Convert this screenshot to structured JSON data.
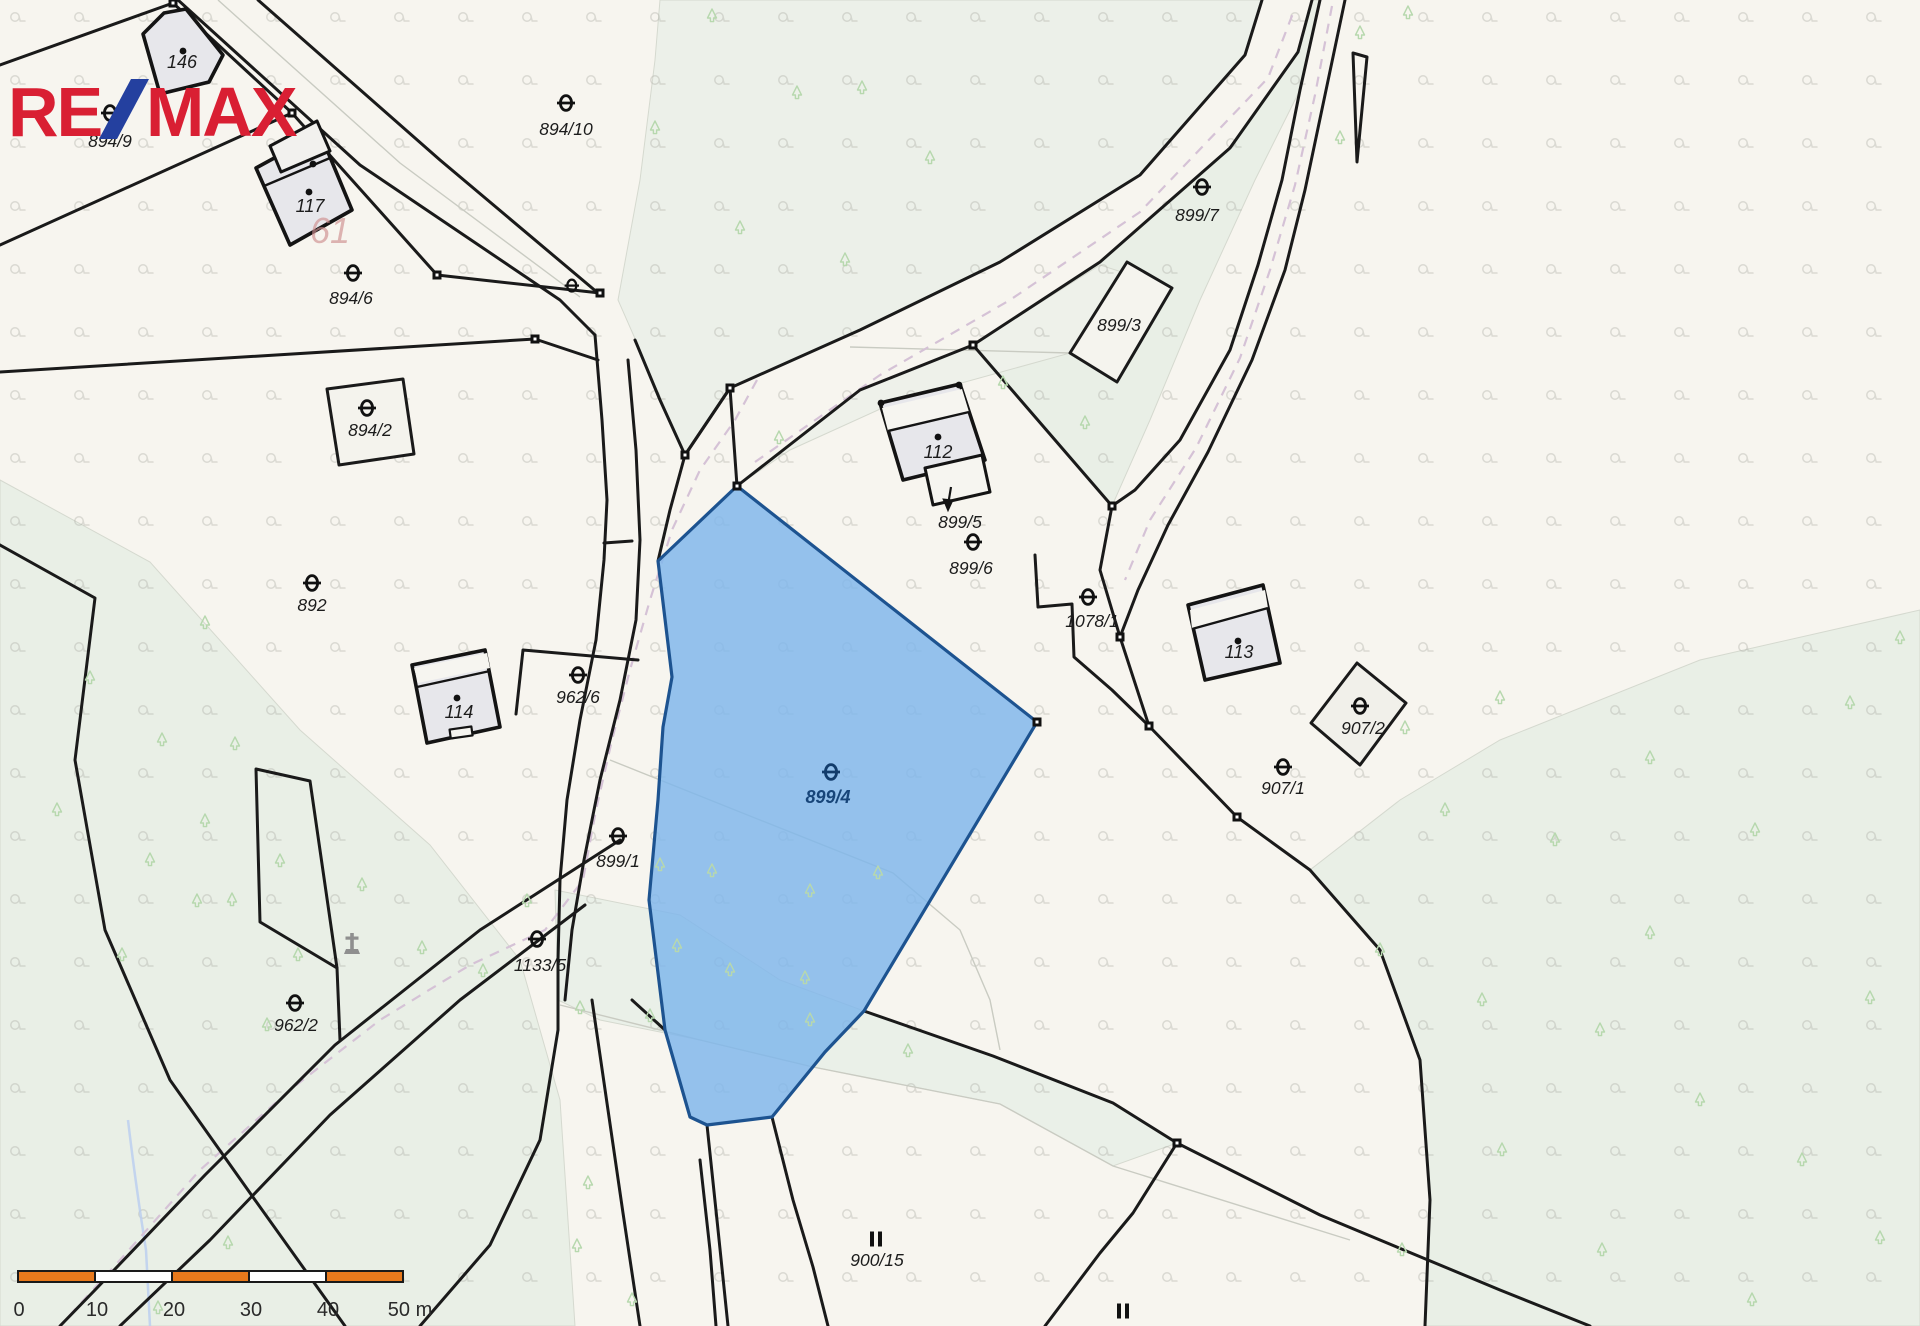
{
  "page": {
    "background": "#f7f5ef"
  },
  "logo": {
    "part1": "RE",
    "part2": "MAX",
    "red": "#d91f33",
    "blue": "#24409f",
    "slash_icon": "diagonal-slash"
  },
  "map": {
    "type": "cadastral-parcel-map",
    "highlight_parcel": {
      "label": "899/4",
      "fill": "#7eb6ec",
      "stroke": "#1d5390",
      "label_color": "#174579"
    },
    "labels": [
      {
        "text": "894/9",
        "x": 110,
        "y": 147,
        "cls": "p"
      },
      {
        "text": "146",
        "x": 182,
        "y": 68,
        "cls": "b"
      },
      {
        "text": "894/10",
        "x": 566,
        "y": 135,
        "cls": "p"
      },
      {
        "text": "117",
        "x": 310,
        "y": 212,
        "cls": "b"
      },
      {
        "text": "894/6",
        "x": 351,
        "y": 304,
        "cls": "p"
      },
      {
        "text": "894/2",
        "x": 370,
        "y": 436,
        "cls": "p"
      },
      {
        "text": "892",
        "x": 312,
        "y": 611,
        "cls": "p"
      },
      {
        "text": "114",
        "x": 459,
        "y": 718,
        "cls": "b"
      },
      {
        "text": "962/6",
        "x": 578,
        "y": 703,
        "cls": "p"
      },
      {
        "text": "899/1",
        "x": 618,
        "y": 867,
        "cls": "p"
      },
      {
        "text": "1133/5",
        "x": 540,
        "y": 971,
        "cls": "p"
      },
      {
        "text": "962/2",
        "x": 296,
        "y": 1031,
        "cls": "p"
      },
      {
        "text": "899/7",
        "x": 1197,
        "y": 221,
        "cls": "p"
      },
      {
        "text": "899/3",
        "x": 1119,
        "y": 331,
        "cls": "p"
      },
      {
        "text": "112",
        "x": 938,
        "y": 458,
        "cls": "b"
      },
      {
        "text": "899/5",
        "x": 960,
        "y": 528,
        "cls": "p"
      },
      {
        "text": "899/6",
        "x": 971,
        "y": 574,
        "cls": "p"
      },
      {
        "text": "1078/1",
        "x": 1092,
        "y": 627,
        "cls": "p"
      },
      {
        "text": "113",
        "x": 1239,
        "y": 658,
        "cls": "b"
      },
      {
        "text": "907/2",
        "x": 1363,
        "y": 734,
        "cls": "p"
      },
      {
        "text": "907/1",
        "x": 1283,
        "y": 794,
        "cls": "p"
      },
      {
        "text": "899/4",
        "x": 828,
        "y": 803,
        "cls": "blue"
      },
      {
        "text": "900/15",
        "x": 877,
        "y": 1266,
        "cls": "p"
      }
    ],
    "faded_territory_number": {
      "text": "61",
      "x": 330,
      "y": 243
    },
    "culture_symbols_theta": [
      [
        110,
        113
      ],
      [
        566,
        103
      ],
      [
        353,
        273
      ],
      [
        367,
        408
      ],
      [
        312,
        583
      ],
      [
        578,
        675
      ],
      [
        618,
        836
      ],
      [
        537,
        939
      ],
      [
        295,
        1003
      ],
      [
        973,
        542
      ],
      [
        1202,
        187
      ],
      [
        1088,
        597
      ],
      [
        1360,
        706
      ],
      [
        1283,
        767
      ]
    ],
    "culture_symbol_theta_blue": [
      831,
      772
    ],
    "culture_symbol_theta_small": [
      953,
      476
    ],
    "grass_symbols": [
      [
        876,
        1239
      ],
      [
        1123,
        1311
      ]
    ],
    "cross_monument": {
      "x": 352,
      "y": 945
    },
    "vertex_markers": [
      [
        173,
        3
      ],
      [
        292,
        113
      ],
      [
        437,
        275
      ],
      [
        535,
        339
      ],
      [
        600,
        293
      ],
      [
        685,
        455
      ],
      [
        730,
        388
      ],
      [
        737,
        486
      ],
      [
        1037,
        722
      ],
      [
        973,
        345
      ],
      [
        1112,
        506
      ],
      [
        1120,
        637
      ],
      [
        1149,
        726
      ],
      [
        1237,
        817
      ],
      [
        1177,
        1143
      ]
    ],
    "building_dots": [
      [
        183,
        51
      ],
      [
        313,
        164
      ],
      [
        309,
        192
      ],
      [
        457,
        698
      ],
      [
        938,
        437
      ],
      [
        1238,
        641
      ],
      [
        881,
        403
      ],
      [
        959,
        385
      ]
    ],
    "trees": [
      [
        712,
        18
      ],
      [
        797,
        95
      ],
      [
        862,
        90
      ],
      [
        930,
        160
      ],
      [
        845,
        262
      ],
      [
        1003,
        385
      ],
      [
        779,
        440
      ],
      [
        1085,
        425
      ],
      [
        655,
        130
      ],
      [
        740,
        230
      ],
      [
        1408,
        15
      ],
      [
        1360,
        35
      ],
      [
        1340,
        140
      ],
      [
        205,
        625
      ],
      [
        90,
        680
      ],
      [
        162,
        742
      ],
      [
        235,
        746
      ],
      [
        57,
        812
      ],
      [
        150,
        862
      ],
      [
        232,
        902
      ],
      [
        122,
        957
      ],
      [
        298,
        957
      ],
      [
        267,
        1027
      ],
      [
        205,
        823
      ],
      [
        197,
        903
      ],
      [
        422,
        950
      ],
      [
        483,
        973
      ],
      [
        527,
        903
      ],
      [
        362,
        887
      ],
      [
        280,
        863
      ],
      [
        228,
        1245
      ],
      [
        158,
        1310
      ],
      [
        660,
        867
      ],
      [
        712,
        873
      ],
      [
        810,
        893
      ],
      [
        878,
        875
      ],
      [
        677,
        948
      ],
      [
        730,
        972
      ],
      [
        805,
        980
      ],
      [
        810,
        1022
      ],
      [
        650,
        1018
      ],
      [
        580,
        1010
      ],
      [
        588,
        1185
      ],
      [
        577,
        1248
      ],
      [
        632,
        1302
      ],
      [
        908,
        1053
      ],
      [
        1405,
        730
      ],
      [
        1500,
        700
      ],
      [
        1445,
        812
      ],
      [
        1555,
        842
      ],
      [
        1650,
        760
      ],
      [
        1755,
        832
      ],
      [
        1850,
        705
      ],
      [
        1380,
        952
      ],
      [
        1482,
        1002
      ],
      [
        1600,
        1032
      ],
      [
        1700,
        1102
      ],
      [
        1802,
        1162
      ],
      [
        1502,
        1152
      ],
      [
        1402,
        1252
      ],
      [
        1602,
        1252
      ],
      [
        1752,
        1302
      ],
      [
        1870,
        1000
      ],
      [
        1650,
        935
      ],
      [
        1900,
        640
      ],
      [
        1880,
        1240
      ]
    ]
  },
  "scalebar": {
    "segment_color": "#e8791c",
    "labels": [
      {
        "text": "0",
        "x": 19
      },
      {
        "text": "10",
        "x": 97
      },
      {
        "text": "20",
        "x": 174
      },
      {
        "text": "30",
        "x": 251
      },
      {
        "text": "40",
        "x": 328
      },
      {
        "text": "50 m",
        "x": 410
      }
    ]
  }
}
